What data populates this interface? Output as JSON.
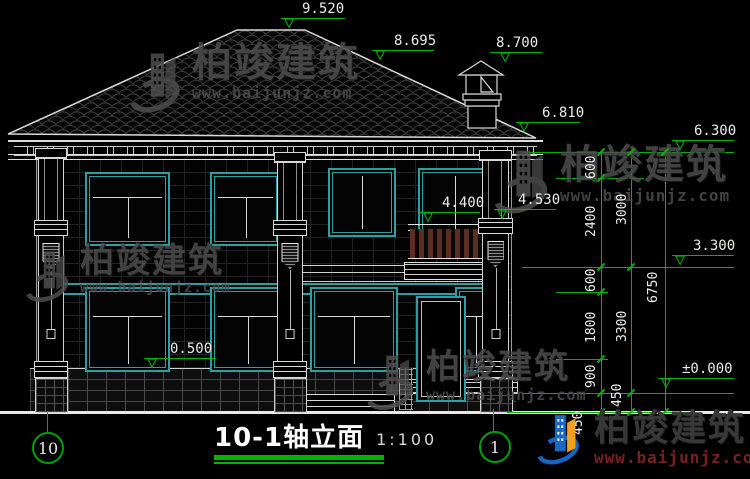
{
  "title_block": {
    "title": "10-1轴立面",
    "scale": "1:100"
  },
  "axes": {
    "left": "10",
    "right": "1"
  },
  "elevations": {
    "ridge": "9.520",
    "roof_mid": "8.695",
    "chimney_top": "8.700",
    "eave_main": "6.810",
    "eave_wing": "6.300",
    "balcony_rail": "4.400",
    "column_capital": "4.530",
    "second_floor": "3.300",
    "plinth_top": "0.500",
    "ground": "±0.000"
  },
  "dimensions": {
    "seg_600_top": "600",
    "seg_2400": "2400",
    "seg_600_mid": "600",
    "seg_1800": "1800",
    "seg_900": "900",
    "seg_450_a": "450",
    "total_3000": "3000",
    "total_3300": "3300",
    "seg_450_b": "450",
    "overall_6750": "6750"
  },
  "watermark": {
    "brand": "柏竣建筑",
    "url": "www.baijunjz.com"
  },
  "icons": {
    "elevation_triangle": "▽"
  },
  "colors": {
    "background": "#000000",
    "line_white": "#e6e6e6",
    "frame_teal": "#2aa0a0",
    "annotation_green": "#00b400",
    "baluster_brown": "#5c2e22",
    "watermark_gray": "#4e4e4e",
    "logo_blue": "#1565c6",
    "logo_orange": "#f0a01e"
  }
}
